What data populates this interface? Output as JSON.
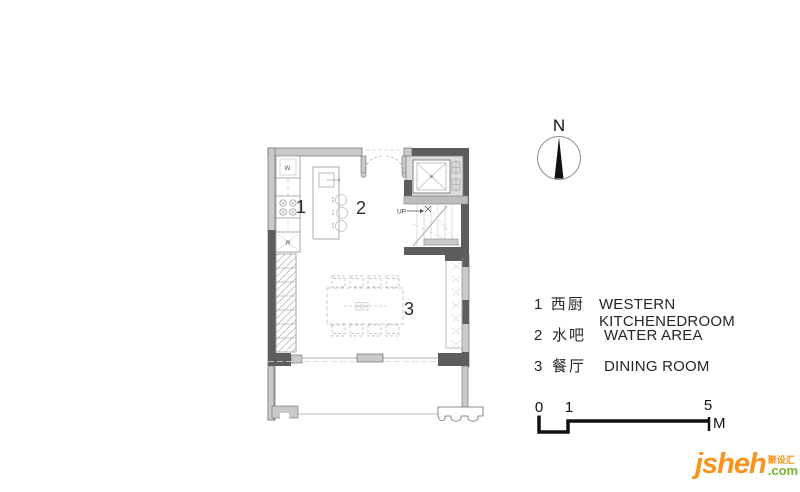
{
  "plan": {
    "room_labels": {
      "kitchen_num": "1",
      "water_num": "2",
      "dining_num": "3"
    },
    "fixture_labels": {
      "washer": "W.",
      "fridge": "R",
      "stairs_up": "UP"
    },
    "colors": {
      "wall_dark": "#5d5d5d",
      "wall_light": "#c9c9c9",
      "line": "#9a9a9a",
      "line_faint": "#c4c4c4"
    }
  },
  "compass": {
    "north_label": "N"
  },
  "legend": {
    "items": [
      {
        "num": "1",
        "zh": "西厨",
        "en": "WESTERN KITCHENEDROOM"
      },
      {
        "num": "2",
        "zh": "水吧",
        "en": "WATER AREA"
      },
      {
        "num": "3",
        "zh": "餐厅",
        "en": "DINING ROOM"
      }
    ]
  },
  "scale_bar": {
    "tick_0": "0",
    "tick_1": "1",
    "tick_5": "5",
    "unit": "M"
  },
  "logo": {
    "name": "jsheh",
    "chinese": "聚设汇",
    "tld": ".com",
    "color_orange": "#f7941e",
    "color_green": "#76b82a"
  }
}
